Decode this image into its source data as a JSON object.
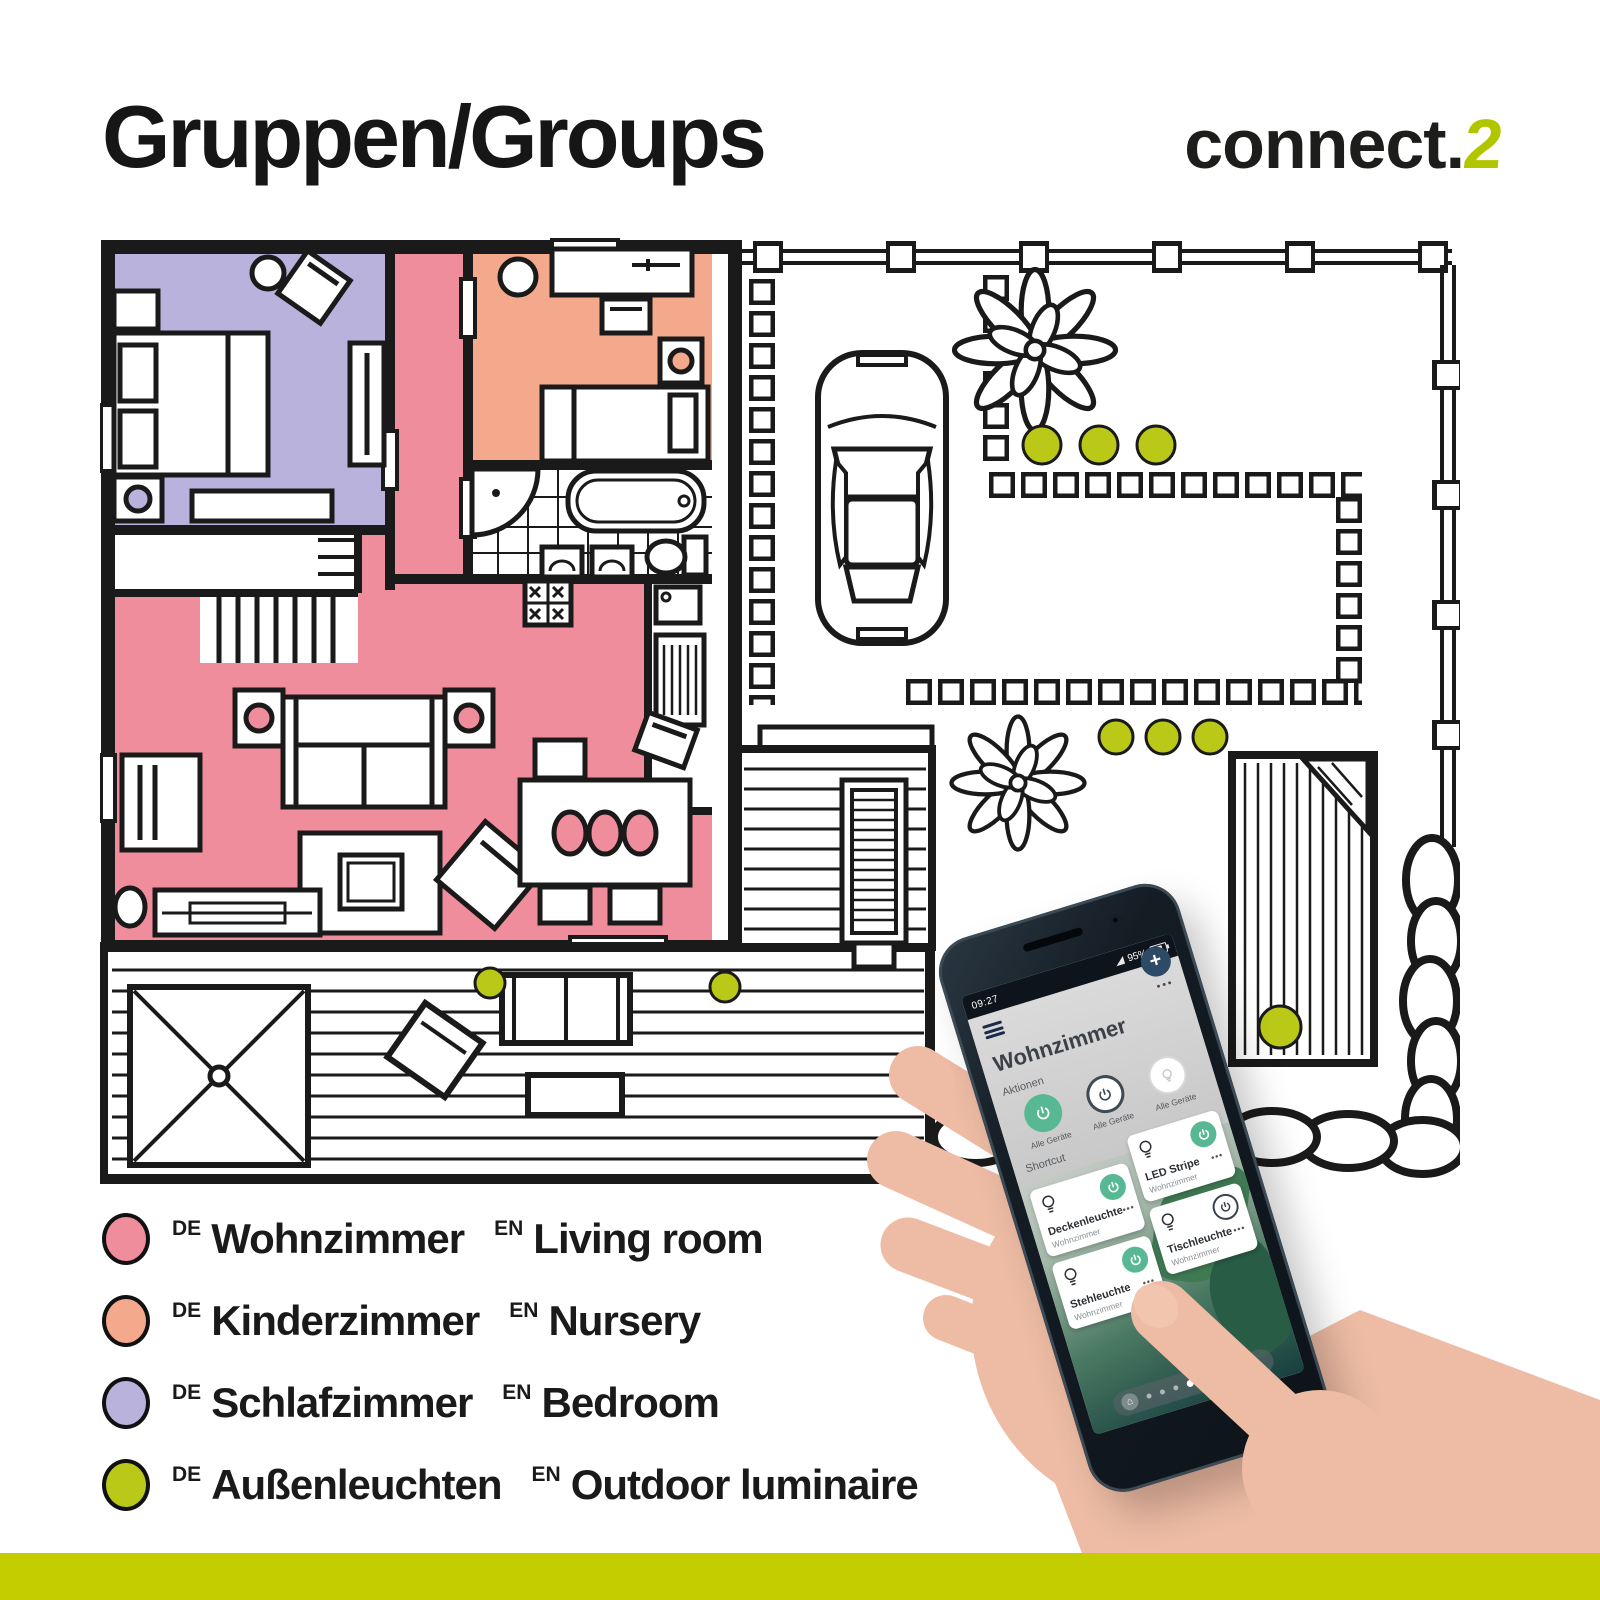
{
  "colors": {
    "pink": "#f08d9d",
    "salmon": "#f5a98c",
    "lavender": "#b9b2dc",
    "lime": "#bac918",
    "footer": "#c4cd00",
    "logo": "#b2c600",
    "appgreen": "#57b893",
    "ink": "#1a1a1a",
    "skin": "#eebca4"
  },
  "header": {
    "title": "Gruppen/Groups",
    "logo_text": "connect.",
    "logo_accent": "2"
  },
  "legend": {
    "de_tag": "DE",
    "en_tag": "EN",
    "items": [
      {
        "de": "Wohnzimmer",
        "en": "Living room",
        "color": "#f08d9d"
      },
      {
        "de": "Kinderzimmer",
        "en": "Nursery",
        "color": "#f5a98c"
      },
      {
        "de": "Schlafzimmer",
        "en": "Bedroom",
        "color": "#b9b2dc"
      },
      {
        "de": "Außenleuchten",
        "en": "Outdoor luminaire",
        "color": "#bac918"
      }
    ]
  },
  "floorplan": {
    "rooms_colored": [
      "Wohnzimmer",
      "Kinderzimmer",
      "Schlafzimmer"
    ],
    "outdoor_light_count": 9
  },
  "phone": {
    "status": {
      "time": "09:27",
      "battery": "95%"
    },
    "app": {
      "title": "Wohnzimmer",
      "more": "•••",
      "plus": "+",
      "home_glyph": "⌂",
      "actions_label": "Aktionen",
      "actions": [
        {
          "label": "Alle Geräte",
          "state": "on"
        },
        {
          "label": "Alle Geräte",
          "state": "off"
        },
        {
          "label": "Alle Geräte",
          "state": "lamp"
        }
      ],
      "shortcut_label": "Shortcut",
      "cards": [
        {
          "name": "Deckenleuchte",
          "room": "Wohnzimmer",
          "power": "on"
        },
        {
          "name": "LED Stripe",
          "room": "Wohnzimmer",
          "power": "on"
        },
        {
          "name": "Stehleuchte",
          "room": "Wohnzimmer",
          "power": "on"
        },
        {
          "name": "Tischleuchte",
          "room": "Wohnzimmer",
          "power": "off"
        }
      ]
    }
  }
}
